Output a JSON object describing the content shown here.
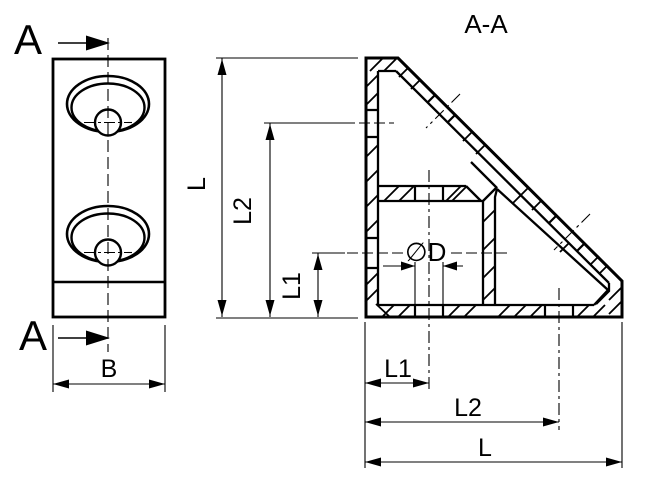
{
  "drawing": {
    "background": "#ffffff",
    "line_color": "#000000",
    "front_view": {
      "cut_label_top": "A",
      "cut_label_bottom": "A",
      "width_dim": "B"
    },
    "section_view": {
      "title": "A-A",
      "hole_dim": "∅D",
      "v_dims": [
        "L",
        "L2",
        "L1"
      ],
      "h_dims": [
        "L1",
        "L2",
        "L"
      ]
    }
  }
}
